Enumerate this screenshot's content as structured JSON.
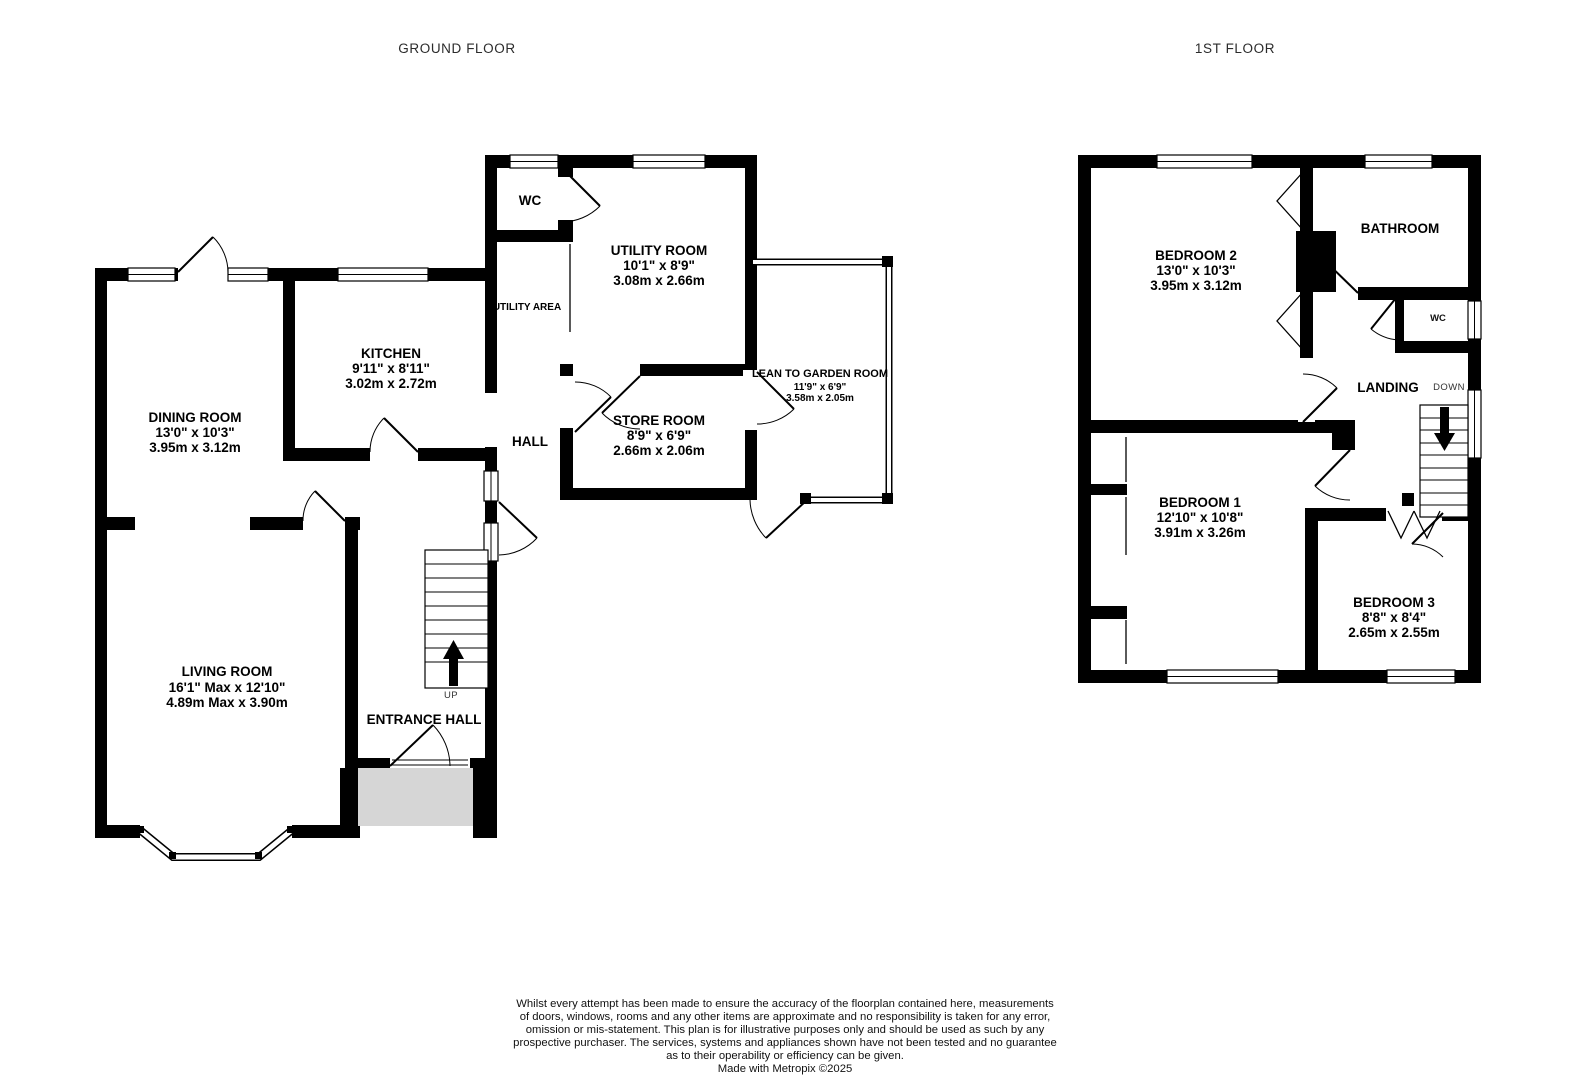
{
  "ground_floor": {
    "title": "GROUND FLOOR",
    "rooms": {
      "wc": {
        "label": "WC"
      },
      "utility_room": {
        "label": "UTILITY ROOM",
        "size_imperial": "10'1\" x 8'9\"",
        "size_metric": "3.08m x 2.66m"
      },
      "utility_area": {
        "label": "UTILITY AREA"
      },
      "kitchen": {
        "label": "KITCHEN",
        "size_imperial": "9'11\" x 8'11\"",
        "size_metric": "3.02m x 2.72m"
      },
      "dining_room": {
        "label": "DINING ROOM",
        "size_imperial": "13'0\" x 10'3\"",
        "size_metric": "3.95m x 3.12m"
      },
      "hall": {
        "label": "HALL"
      },
      "store_room": {
        "label": "STORE ROOM",
        "size_imperial": "8'9\" x 6'9\"",
        "size_metric": "2.66m x 2.06m"
      },
      "lean_to_garden_room": {
        "label": "LEAN TO GARDEN ROOM",
        "size_imperial": "11'9\" x 6'9\"",
        "size_metric": "3.58m x 2.05m"
      },
      "living_room": {
        "label": "LIVING ROOM",
        "size_imperial": "16'1\" Max x 12'10\"",
        "size_metric": "4.89m Max x 3.90m"
      },
      "entrance_hall": {
        "label": "ENTRANCE HALL"
      }
    },
    "stairs": {
      "direction_label": "UP"
    }
  },
  "first_floor": {
    "title": "1ST FLOOR",
    "rooms": {
      "bedroom_2": {
        "label": "BEDROOM 2",
        "size_imperial": "13'0\" x 10'3\"",
        "size_metric": "3.95m x 3.12m"
      },
      "bathroom": {
        "label": "BATHROOM"
      },
      "wc": {
        "label": "WC"
      },
      "landing": {
        "label": "LANDING"
      },
      "bedroom_1": {
        "label": "BEDROOM 1",
        "size_imperial": "12'10\" x 10'8\"",
        "size_metric": "3.91m x 3.26m"
      },
      "bedroom_3": {
        "label": "BEDROOM 3",
        "size_imperial": "8'8\" x 8'4\"",
        "size_metric": "2.65m x 2.55m"
      }
    },
    "stairs": {
      "direction_label": "DOWN"
    }
  },
  "disclaimer": {
    "lines": [
      "Whilst every attempt has been made to ensure the accuracy of the floorplan contained here, measurements",
      "of doors, windows, rooms and any other items are approximate and no responsibility is taken for any error,",
      "omission or mis-statement. This plan is for illustrative purposes only and should be used as such by any",
      "prospective purchaser. The services, systems and appliances shown have not been tested and no guarantee",
      "as to their operability or efficiency can be given."
    ],
    "credit": "Made with Metropix ©2025"
  },
  "colors": {
    "wall": "#000000",
    "floor": "#ffffff",
    "porch": "#d6d6d6"
  }
}
